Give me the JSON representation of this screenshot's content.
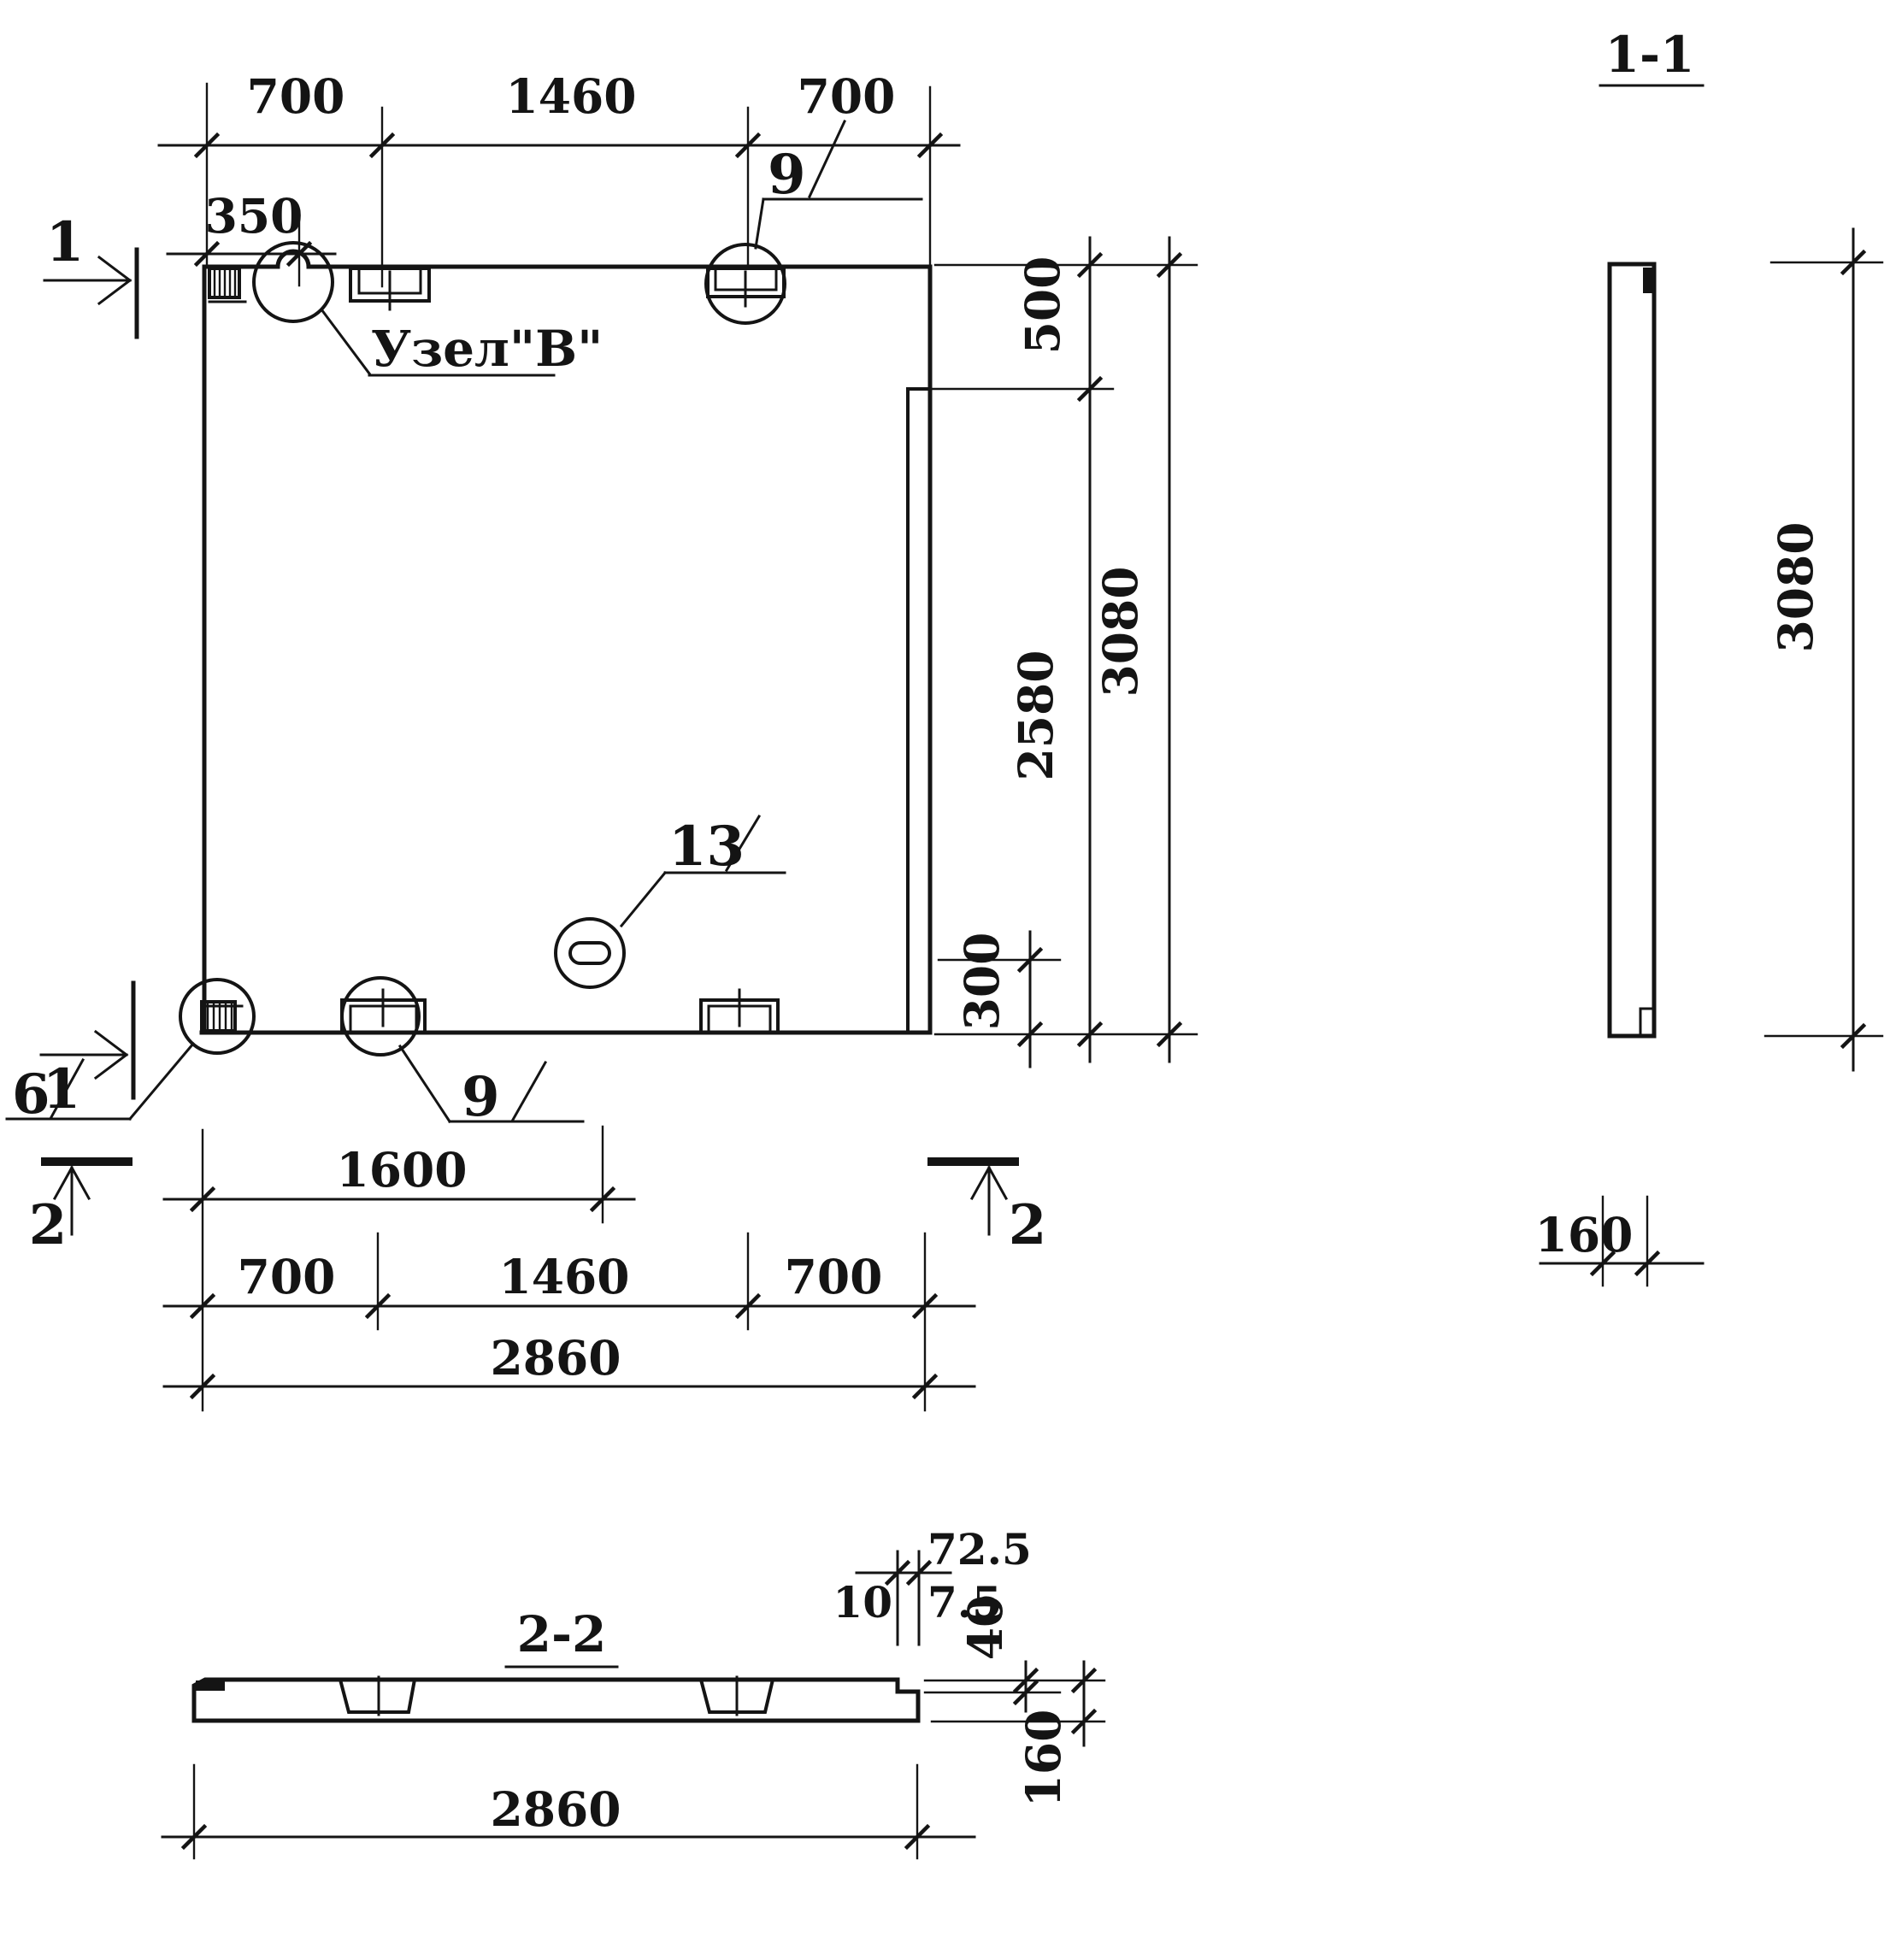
{
  "plan": {
    "top_dims": {
      "seg1": "700",
      "seg2": "1460",
      "seg3": "700",
      "offset": "350"
    },
    "right_dims": {
      "top": "500",
      "middle": "2580",
      "overall": "3080",
      "bottom": "300"
    },
    "bottom_dims": {
      "half": "1600",
      "seg1": "700",
      "seg2": "1460",
      "seg3": "700",
      "overall": "2860"
    },
    "callouts": {
      "node_b": "Узел\"В\"",
      "c9_top": "9",
      "c13": "13",
      "c6": "6",
      "c9_bottom": "9"
    },
    "markers": {
      "s1_top": "1",
      "s1_bottom": "1",
      "s2_left": "2",
      "s2_right": "2"
    }
  },
  "section_1_1": {
    "title": "1-1",
    "height": "3080",
    "thickness": "160"
  },
  "section_2_2": {
    "title": "2-2",
    "overall": "2860",
    "thickness": "160",
    "step_depth": "40",
    "d72_5": "72.5",
    "d10": "10",
    "d7_5": "7.5"
  }
}
